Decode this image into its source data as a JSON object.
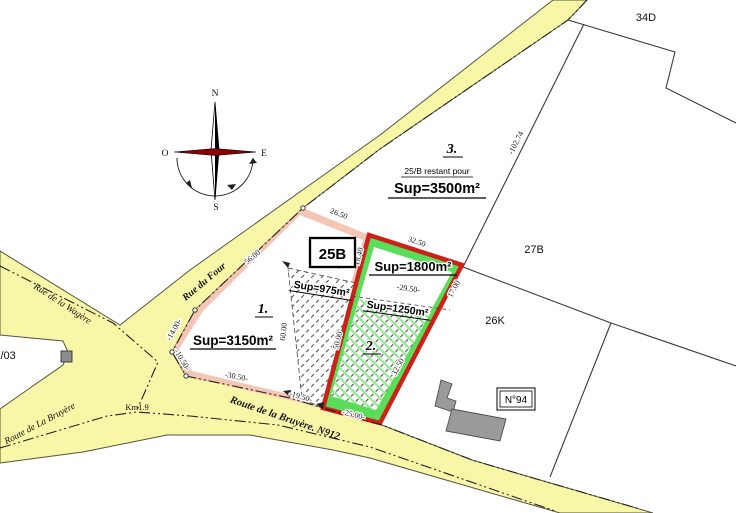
{
  "map": {
    "parcels": {
      "p34d": "34D",
      "p27b": "27B",
      "p26k": "26K",
      "p5303": "53/03"
    },
    "boxes": {
      "b25": "25B",
      "n94": "N°94"
    },
    "zones": {
      "z1": {
        "num": "1.",
        "sup": "Sup=3150m²"
      },
      "z2": {
        "num": "2.",
        "sup": "Sup=1800m²",
        "inner": "Sup=1250m²"
      },
      "z3": {
        "num": "3.",
        "note": "25/B restant pour",
        "sup": "Sup=3500m²"
      },
      "strip": {
        "sup": "Sup=975m²"
      }
    },
    "roads": {
      "four": "Rue du Four",
      "wagere": "Rue de la Wagère",
      "bruyere_sw": "Route de La Bruyère",
      "n912": "Route de la Bruyère. N912",
      "km": "Km1.9"
    },
    "compass": {
      "n": "N",
      "s": "S",
      "e": "E",
      "o": "O"
    },
    "dimensions": {
      "d26_50": "26.50",
      "d56": "56.00",
      "d14": "-14.00-",
      "d10": "-10.50-",
      "d30": "-30.50-",
      "d19_top": "-19.50-",
      "d19_bot": "-19.50-",
      "d60": "60.00",
      "d50": "50.00",
      "d18": "18.40",
      "d32_top": "32.50",
      "d29": "-29.50-",
      "d17": "17.00",
      "d32_right": "32.50",
      "d25": "-25.00-",
      "d102": "-102.74"
    },
    "colors": {
      "road_fill": "#f8f7a8",
      "road_border": "#55553f",
      "parcel1_band": "#f5c5b5",
      "parcel2_border": "#cc2018",
      "parcel2_band": "#5ade5a",
      "hatch_dash": "#555555",
      "building_gray": "#9a9a9a",
      "compass_red": "#8b0000"
    }
  }
}
